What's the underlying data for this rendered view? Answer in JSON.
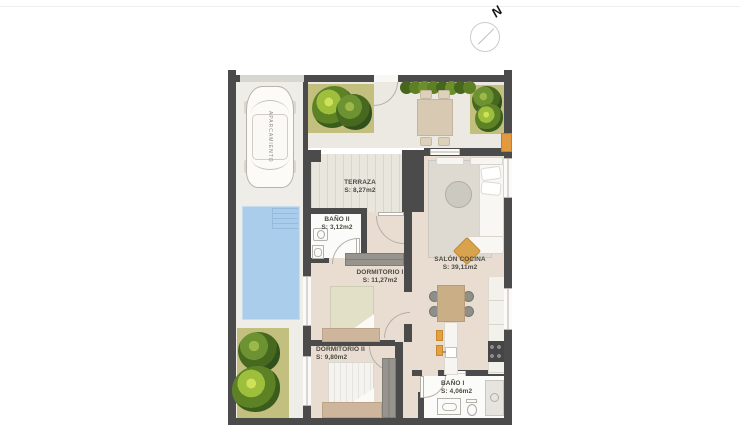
{
  "compass": {
    "north_label": "N"
  },
  "parking": {
    "label": "APARCAMIENTO"
  },
  "rooms": {
    "terraza": {
      "name": "TERRAZA",
      "area": "S: 8,27m2"
    },
    "bano2": {
      "name": "BAÑO II",
      "area": "S: 3,12m2"
    },
    "dorm1": {
      "name": "DORMITORIO I",
      "area": "S: 11,27m2"
    },
    "salon": {
      "name": "SALÓN COCINA",
      "area": "S: 39,11m2"
    },
    "dorm2": {
      "name": "DORMITORIO II",
      "area": "S: 9,80m2"
    },
    "bano1": {
      "name": "BAÑO I",
      "area": "S: 4,06m2"
    }
  },
  "colors": {
    "wall": "#4b4b4b",
    "pool": "#a9cdeb",
    "lawn": "#c3c07f",
    "interior_floor": "#e9ddd2",
    "exterior_floor": "#efede7",
    "accent_orange": "#e2993f",
    "furniture_wood": "#cdb69c"
  }
}
